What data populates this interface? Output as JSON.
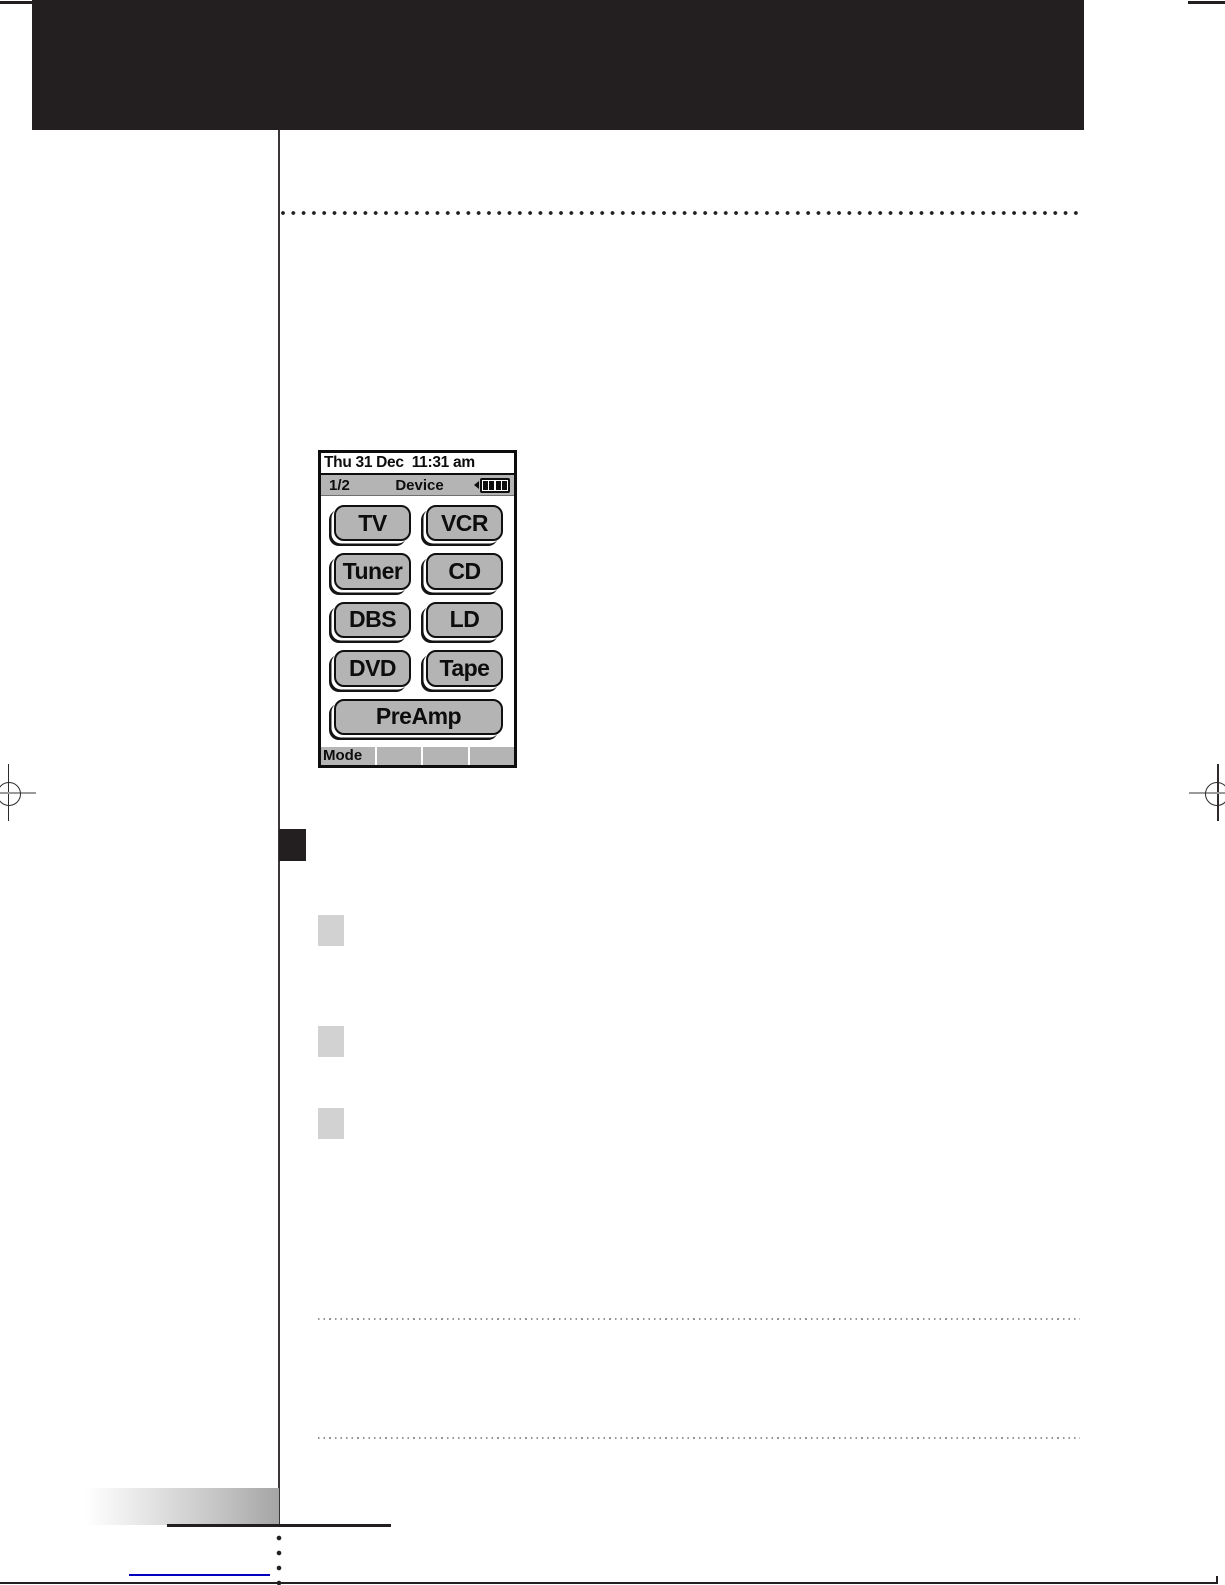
{
  "remote_screen": {
    "title_bar": {
      "datetime": "Thu 31 Dec  11:31 am"
    },
    "status_bar": {
      "page_indicator": "1/2",
      "mode_label": "Device",
      "battery_icon": "battery-4-bars"
    },
    "device_buttons": [
      "TV",
      "VCR",
      "Tuner",
      "CD",
      "DBS",
      "LD",
      "DVD",
      "Tape"
    ],
    "preamp_button": "PreAmp",
    "bottom_bar": {
      "mode_softkey_label": "Mode",
      "empty_segment_count": 3
    }
  },
  "colors": {
    "print_black": "#231f20",
    "lcd_button_gray": "#b4b4b4",
    "lcd_bar_gray": "#b4b4b4",
    "step_square_gray": "#d2d2d2",
    "step_square_black": "#231f20",
    "link_blue": "#0000bf",
    "fine_dot_gray": "#949494"
  }
}
